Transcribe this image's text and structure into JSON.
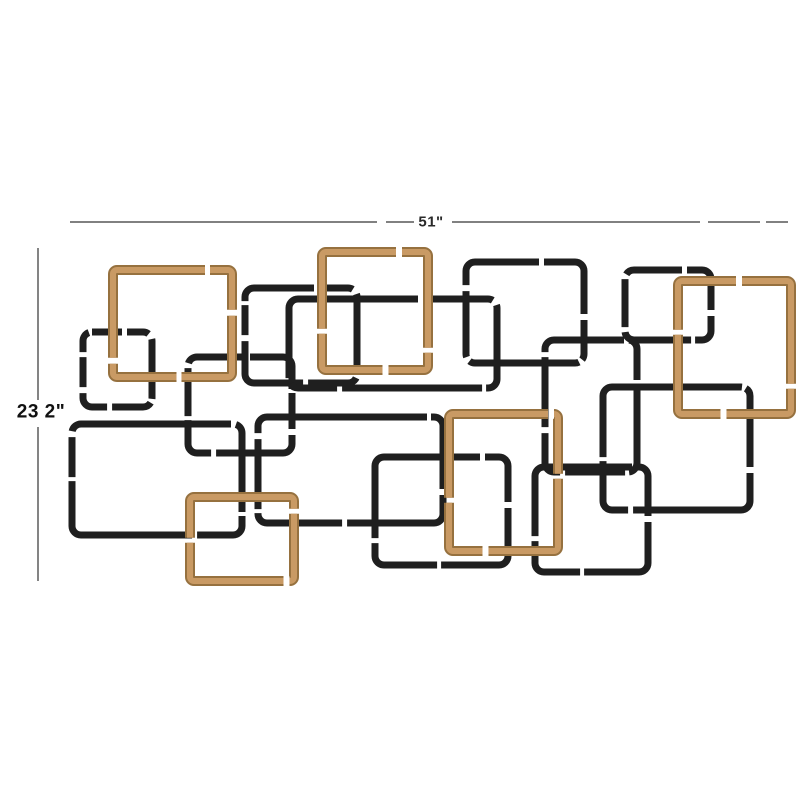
{
  "product_diagram": {
    "description": "dimension diagram of interlocking-squares metal wall decor",
    "dimensions": {
      "width_label": "51\"",
      "height_label": "23 2\""
    },
    "colors": {
      "background": "#ffffff",
      "black_metal": "#1f1f1f",
      "gold_metal_light": "#c99a64",
      "gold_metal_dark": "#96713f",
      "dimension_line": "#6f6f6f",
      "label_text": "#111111"
    },
    "width_line": {
      "y": 222,
      "segments": [
        [
          70,
          377
        ],
        [
          386,
          414
        ],
        [
          452,
          700
        ],
        [
          708,
          760
        ],
        [
          766,
          788
        ]
      ]
    },
    "height_line": {
      "x": 38,
      "segments": [
        [
          248,
          400
        ],
        [
          427,
          581
        ]
      ]
    },
    "squares": [
      {
        "id": "black-small-left",
        "color": "black",
        "x": 83,
        "y": 332,
        "w": 69,
        "h": 75,
        "rx": 9,
        "dash": "30 5 22 6 60 4 40 5 34 6"
      },
      {
        "id": "black-mid-left",
        "color": "black",
        "x": 188,
        "y": 357,
        "w": 104,
        "h": 96,
        "rx": 9,
        "dash": "48 5 70 4 36 6 90 5 52 4"
      },
      {
        "id": "black-bottom-left-wide",
        "color": "black",
        "x": 72,
        "y": 424,
        "w": 170,
        "h": 111,
        "rx": 9,
        "dash": "150 5 90 4 60 5 170 4 40 6"
      },
      {
        "id": "black-top-center-left",
        "color": "black",
        "x": 245,
        "y": 288,
        "w": 112,
        "h": 95,
        "rx": 9,
        "dash": "60 5 34 6 80 4 50 5 96 6 30 4"
      },
      {
        "id": "black-center-wide",
        "color": "black",
        "x": 289,
        "y": 299,
        "w": 208,
        "h": 89,
        "rx": 9,
        "dash": "120 5 70 6 90 4 140 5 48 6"
      },
      {
        "id": "gold-top-left",
        "color": "gold",
        "x": 113,
        "y": 270,
        "w": 119,
        "h": 107,
        "rx": 4,
        "dash": "88 5 60 6 110 5 75 6 140 5"
      },
      {
        "id": "black-top-center-right",
        "color": "black",
        "x": 466,
        "y": 262,
        "w": 118,
        "h": 101,
        "rx": 9,
        "dash": "64 5 88 6 40 4 110 5 66 6"
      },
      {
        "id": "black-top-right-small",
        "color": "black",
        "x": 625,
        "y": 270,
        "w": 86,
        "h": 70,
        "rx": 9,
        "dash": "48 5 60 6 36 4 70 5"
      },
      {
        "id": "black-right-mid",
        "color": "black",
        "x": 545,
        "y": 340,
        "w": 92,
        "h": 132,
        "rx": 9,
        "dash": "70 5 44 6 90 4 60 5 50 6"
      },
      {
        "id": "gold-top-middle",
        "color": "gold",
        "x": 322,
        "y": 252,
        "w": 106,
        "h": 118,
        "rx": 4,
        "dash": "70 6 120 5 55 6 95 5 130 6"
      },
      {
        "id": "black-center-big",
        "color": "black",
        "x": 258,
        "y": 417,
        "w": 185,
        "h": 106,
        "rx": 9,
        "dash": "160 4 80 6 120 5 90 4 70 6"
      },
      {
        "id": "black-right-big",
        "color": "black",
        "x": 603,
        "y": 387,
        "w": 147,
        "h": 123,
        "rx": 9,
        "dash": "130 4 80 6 150 5 70 4 90 6"
      },
      {
        "id": "gold-top-right",
        "color": "gold",
        "x": 678,
        "y": 281,
        "w": 113,
        "h": 133,
        "rx": 4,
        "dash": "54 6 150 5 88 6 120 5"
      },
      {
        "id": "black-bottom-center",
        "color": "black",
        "x": 375,
        "y": 457,
        "w": 133,
        "h": 108,
        "rx": 9,
        "dash": "96 5 64 6 120 4 80 5"
      },
      {
        "id": "black-bottom-right",
        "color": "black",
        "x": 535,
        "y": 467,
        "w": 113,
        "h": 105,
        "rx": 9,
        "dash": "88 5 56 6 110 4 72 5"
      },
      {
        "id": "gold-bottom-center",
        "color": "gold",
        "x": 449,
        "y": 414,
        "w": 109,
        "h": 137,
        "rx": 4,
        "dash": "95 6 62 5 140 6 80 5"
      },
      {
        "id": "gold-bottom-left",
        "color": "gold",
        "x": 190,
        "y": 497,
        "w": 104,
        "h": 84,
        "rx": 4,
        "dash": "110 5 70 6 130 5 60 6"
      }
    ]
  }
}
